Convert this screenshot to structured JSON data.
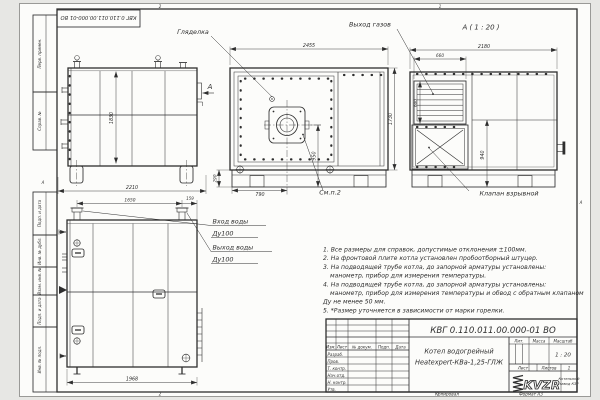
{
  "sheet": {
    "doc_number_top": "КВГ 0.110.011.00.000-01 ВО",
    "zones": {
      "top_left": "2",
      "top_right": "1",
      "bottom_left": "2",
      "bottom_right": "1",
      "fold_left": "А",
      "fold_right": "А"
    }
  },
  "margin_labels": [
    "Перв. примен.",
    "Справ. №",
    "Подп. и дата",
    "Инв. № дубл.",
    "Взам. инв. №",
    "Подп. и дата",
    "Инв. № подл."
  ],
  "views": {
    "side": {
      "dim_height": "1830",
      "dim_width": "2210",
      "view_arrow_label": "А"
    },
    "front": {
      "dim_width": "2455",
      "dim_burner_offset": "790",
      "dim_burner_height": "950",
      "dim_base_height": "290",
      "dim_right_height": "1730",
      "label_sight_glass": "Гляделка",
      "label_see_item": "См.п.2"
    },
    "view_a": {
      "title": "А ( 1 : 20 )",
      "label_gas_outlet": "Выход газов",
      "label_explosion_valve": "Клапан взрывной",
      "dim_width": "2180",
      "dim_louver_width": "660",
      "dim_louver_height": "600",
      "dim_valve_height": "940"
    },
    "rear": {
      "dim_pipe_span": "1650",
      "dim_pipe_edge": "159",
      "dim_width": "1968",
      "label_water_in": "Вход воды",
      "label_water_in_dn": "Ду100",
      "label_water_out": "Выход воды",
      "label_water_out_dn": "Ду100"
    }
  },
  "notes": [
    "1. Все размеры для справок, допустимые отклонения ±100мм.",
    "2. На фронтовой плите котла установлен пробоотборный штуцер.",
    "3. На подводящей трубе котла, до запорной арматуры установлены:",
    "манометр, прибор для измерения температуры.",
    "4. На подводящей трубе котла, до запорной арматуры установлены:",
    "манометр, прибор для измерения температуры и обвод с обратным клапаном",
    "Ду не менее 50 мм.",
    "5. *Размер уточняется в зависимости от марки горелки."
  ],
  "title_block": {
    "doc_number": "КВГ 0.110.011.00.000-01 ВО",
    "product_name_line1": "Котел водогрейный",
    "product_name_line2": "Heatexpert-КВа-1,25-ГЛЖ",
    "col_izm": "Изм.",
    "col_list": "Лист",
    "col_doc": "№ докум.",
    "col_podp": "Подп.",
    "col_data": "Дата",
    "rows": [
      "Разраб.",
      "Пров.",
      "Т. контр.",
      "Нач.отд.",
      "Н. контр.",
      "Утв."
    ],
    "lit_label": "Лит.",
    "mass_label": "Масса",
    "scale_label": "Масштаб",
    "scale_value": "1 : 20",
    "sheet_label": "Лист",
    "sheets_label": "Листов",
    "sheets_value": "1",
    "logo_text": "KVZR",
    "logo_caption_line1": "Котельный",
    "logo_caption_line2": "завод КЗР",
    "footer_copy": "Копировал",
    "footer_format": "Формат А3"
  }
}
